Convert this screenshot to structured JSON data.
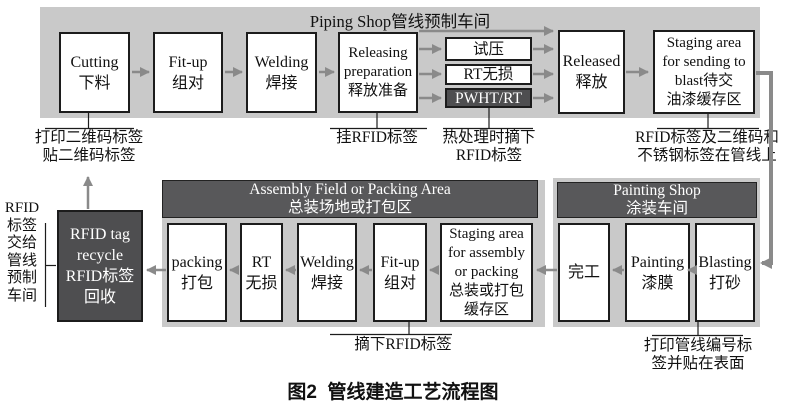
{
  "colors": {
    "container_bg": "#c9c9c9",
    "banner_bg": "#58585a",
    "dark_box_bg": "#4e4e50",
    "box_bg": "#ffffff",
    "box_border": "#1c1c1c",
    "arrow": "#8a8a8a",
    "text": "#111111",
    "banner_text": "#ffffff"
  },
  "piping_shop": {
    "title": "Piping Shop管线预制车间",
    "cutting": "Cutting\n下料",
    "fit_up": "Fit-up\n组对",
    "welding": "Welding\n焊接",
    "releasing_preparation": "Releasing\npreparation\n释放准备",
    "pressure_test": "试压",
    "rt_ndt": "RT无损",
    "pwht_rt": "PWHT/RT",
    "released": "Released\n释放",
    "staging_blast": "Staging area\nfor sending to\nblast待交\n油漆缓存区"
  },
  "annotations": {
    "print_qr": "打印二维码标签\n贴二维码标签",
    "hang_rfid": "挂RFID标签",
    "heat_remove_rfid": "热处理时摘下\nRFID标签",
    "labels_on_pipe": "RFID标签及二维码和\n不锈钢标签在管线上",
    "remove_rfid": "摘下RFID标签",
    "print_pipe_number": "打印管线编号标\n签并贴在表面",
    "rfid_to_shop": "RFID\n标签\n交给\n管线\n预制\n车间"
  },
  "assembly_area": {
    "title": "Assembly Field or Packing Area\n总装场地或打包区",
    "packing": "packing\n打包",
    "rt": "RT\n无损",
    "welding": "Welding\n焊接",
    "fit_up": "Fit-up\n组对",
    "staging_assembly": "Staging area\nfor assembly\nor packing\n总装或打包\n缓存区"
  },
  "rfid_recycle": "RFID tag\nrecycle\nRFID标签\n回收",
  "painting_shop": {
    "title": "Painting Shop\n涂装车间",
    "done": "完工",
    "painting": "Painting\n漆膜",
    "blasting": "Blasting\n打砂"
  },
  "caption": "图2  管线建造工艺流程图"
}
